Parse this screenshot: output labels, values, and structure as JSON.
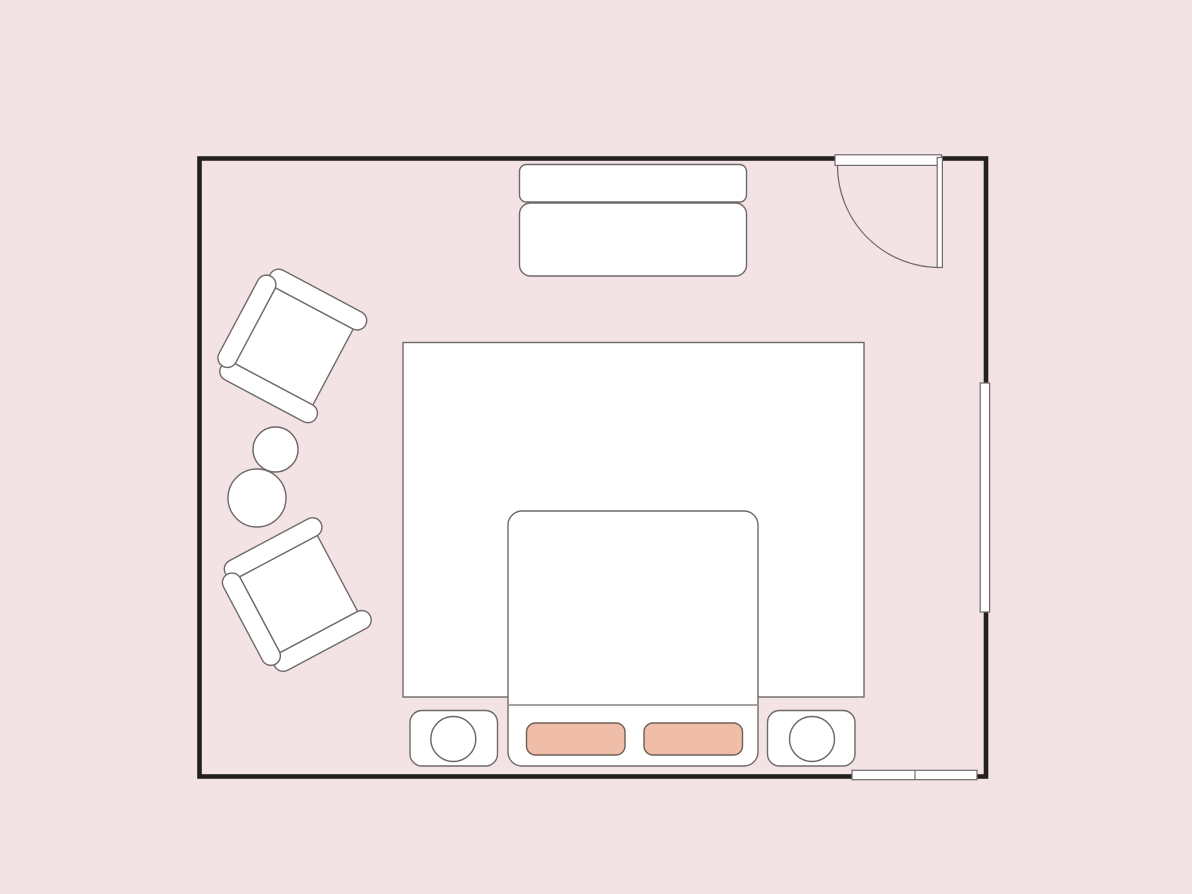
{
  "diagram": {
    "kind": "floor-plan",
    "objects": [
      "room-walls",
      "hinged-door",
      "window-right-wall",
      "window-bottom-wall",
      "sideboard",
      "armchair-top-left",
      "armchair-bottom-left",
      "side-table-small",
      "side-table-large",
      "area-rug",
      "bed",
      "pillow-left",
      "pillow-right",
      "nightstand-left",
      "lamp-left",
      "nightstand-right",
      "lamp-right"
    ]
  },
  "colors": {
    "background": "#f4e3e5",
    "wall": "#232021",
    "outline": "#6f696a",
    "furniture_fill": "#ffffff",
    "pillow_fill": "#f0bda9",
    "pillow_outline": "#6b6055"
  }
}
